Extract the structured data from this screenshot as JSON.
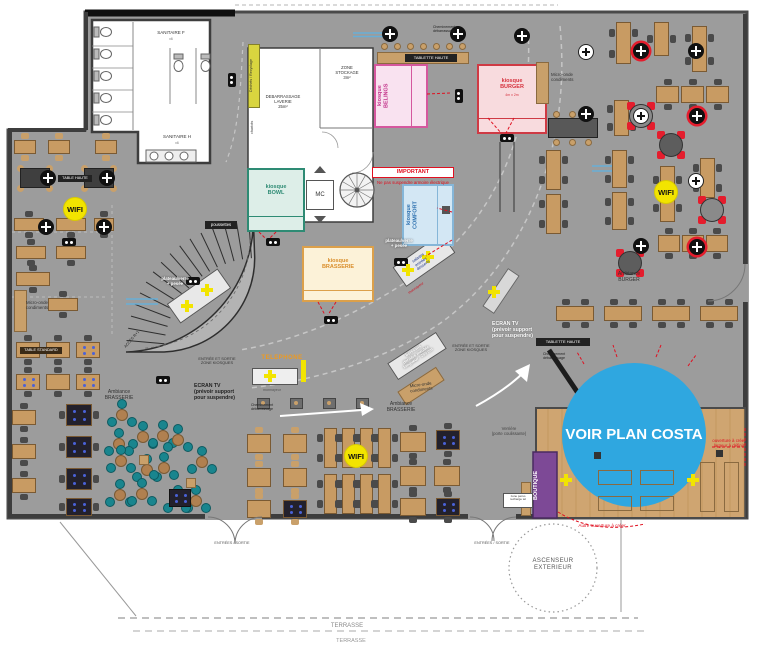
{
  "rooms": {
    "sanitaire_f": "SANITAIRE F",
    "sanitaire_f_sub": "x6",
    "sanitaire_h": "SANITAIRE H",
    "sanitaire_h_sub": "x6",
    "debarrassage": "DEBARRASSAGE\nLAVERIE\n25m²",
    "zone_stockage": "ZONE\nSTOCKAGE\n3m²",
    "mc": "MC",
    "boutique": "BOUTIQUE"
  },
  "kiosks": {
    "bowl": {
      "label": "kiosque\nBOWL"
    },
    "belings": {
      "label": "kiosque\nBELINGS"
    },
    "burger": {
      "label": "kiosque\nBURGER",
      "dim": "4m x 2m"
    },
    "comfort": {
      "label": "kiosque\nCOMFORT"
    },
    "brasserie": {
      "label": "kiosque\nBRASSERIE"
    }
  },
  "labels": {
    "dechets": "Déchets / Recyclage",
    "chariots": "chariots",
    "important": "IMPORTANT",
    "important_note": "Ne pas suspendre armoire électrique",
    "micro_onde": "Micro-onde\ncondiments",
    "tablette_haute": "TABLETTE HAUTE",
    "table_haute": "TABLE HAUTE",
    "table_standard": "TABLE STANDARD",
    "poussettes": "poussettes",
    "acces": "ACCÈS R+1",
    "entree_zone": "ENTRÉE ET SORTIE\nZONE KIOSQUES",
    "telephone": "TELEPHONE",
    "ecran_tv": "ECRAN TV\n(prévoir support\npour suspendre)",
    "cheminement": "Cheminement\ndébarrassage",
    "plateau": "plateau/verre\n+ pesée",
    "salades": "salades\nentrées\ndesserts",
    "monnayeur": "monnayeur",
    "boissons": "boissons\nderrière meuble\nlongueur : 250 cm",
    "ambiance_brasserie": "Ambiance\nBRASSERIE",
    "ambiance_burger": "Ambiance\nBURGER",
    "wifi": "WIFI",
    "verriere": "Verrière\n(porte coulissante)",
    "costa": "VOIR PLAN COSTA",
    "ouverture": "ouverture à créer\nlargeur à définir",
    "autre_ouverture": "Autre ouverture à créer",
    "ascenseur": "ASCENSEUR\nEXTERIEUR",
    "entrees_sortie": "ENTRÉES / SORTIE",
    "terrasse": "TERRASSE",
    "zone_perso": "zone perso\nrecharge tel"
  },
  "colors": {
    "floor_gray": "#9c9c9c",
    "costa_blue": "#2fa7e0",
    "boutique_purple": "#7d4996",
    "wifi_yellow": "#f2e400",
    "wood_floor": "#cfa571",
    "kiosk_bowl_green": "#2e8b74",
    "kiosk_belings_pink": "#d5579e",
    "kiosk_burger_red": "#cf3a44",
    "kiosk_comfort_blue": "#2b6fae",
    "kiosk_brasserie_orange": "#dca04a",
    "annotation_red": "#e01020"
  }
}
